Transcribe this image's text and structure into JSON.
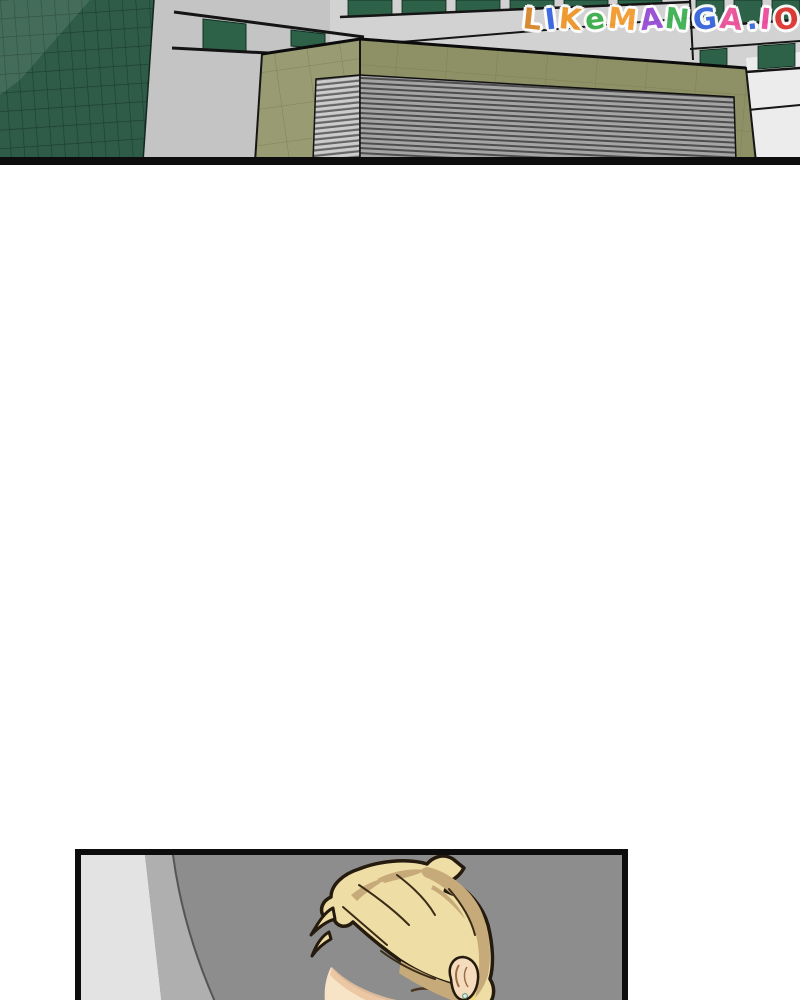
{
  "watermark": {
    "text": "LIKeMANGA.IO",
    "letters": [
      {
        "ch": "L",
        "color": "#d98a2b"
      },
      {
        "ch": "I",
        "color": "#3b66e3"
      },
      {
        "ch": "K",
        "color": "#f0982c"
      },
      {
        "ch": "e",
        "color": "#3fb04d"
      },
      {
        "ch": "M",
        "color": "#f59d33"
      },
      {
        "ch": "A",
        "color": "#9a4fd8"
      },
      {
        "ch": "N",
        "color": "#43b355"
      },
      {
        "ch": "G",
        "color": "#3f6be0"
      },
      {
        "ch": "A",
        "color": "#f0569c"
      },
      {
        "ch": ".",
        "color": "#3f6be0"
      },
      {
        "ch": "I",
        "color": "#ee4fa0"
      },
      {
        "ch": "O",
        "color": "#e03a35"
      }
    ]
  },
  "colors": {
    "sky": "#c4c4c4",
    "right_wall": "#d2d2d2",
    "right_wall_bright": "#ececec",
    "glass_green": "#2d6148",
    "tower_green": "#2f5c49",
    "tower_grid": "#1d4034",
    "olive_left": "#999c72",
    "olive_front": "#8e9166",
    "olive_grid": "#787a52",
    "louver_light_front": "#a4a4a4",
    "louver_dark_front": "#4e4e4e",
    "louver_light_left": "#cccccc",
    "louver_dark_left": "#666666",
    "ink": "#0d0d0d",
    "panel_bg": "#8d8d8d",
    "wall_light": "#e3e3e3",
    "wall_mid": "#afafaf",
    "hair_light": "#efdda6",
    "hair_tan": "#c7aa79",
    "hair_bright": "#eed678",
    "skin": "#f7e3c6",
    "skin_shadow": "#e9c29e",
    "outline": "#241a0e"
  },
  "panels": {
    "top": {
      "description": "Exterior of modern buildings: dark green glass tower, khaki rooftop block with gray louvered vent, building with green window bands"
    },
    "bottom": {
      "description": "Blond-haired person seen with head bowed in a gray room, ear with small earring visible"
    }
  }
}
